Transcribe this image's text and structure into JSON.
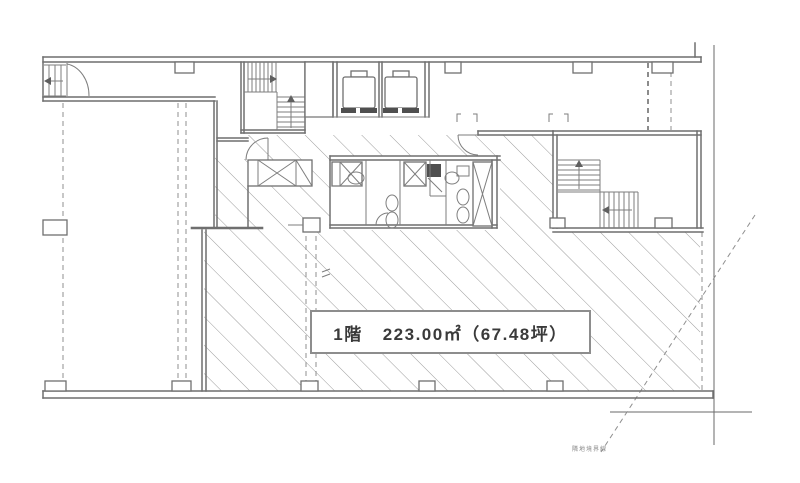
{
  "drawing": {
    "type": "floor-plan",
    "label_box": {
      "floor": "1階",
      "area_sqm": "223.00㎡",
      "area_tsubo": "（67.48坪）",
      "area_sqm_value": 223.0,
      "area_tsubo_value": 67.48
    },
    "annotations": {
      "boundary_note": "隣地境界線"
    },
    "colors": {
      "background": "#ffffff",
      "wall_line": "#6f6f6f",
      "hatch_line": "#9c9c9c",
      "dashed_line": "#8f8f8f",
      "label_text": "#3a3a3a",
      "dark_shaft_fill": "#4f4f4f"
    }
  }
}
